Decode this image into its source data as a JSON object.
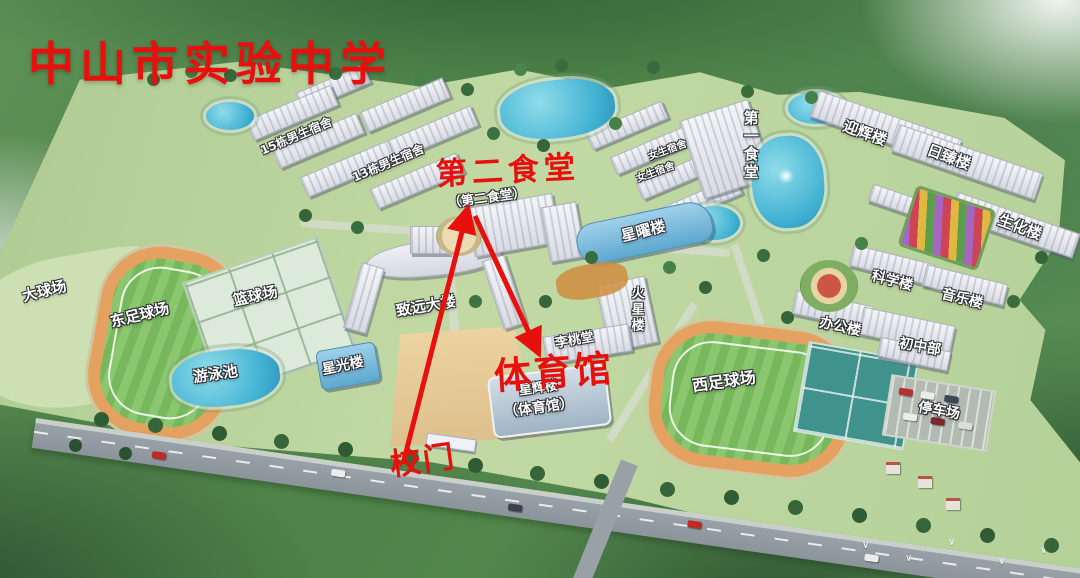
{
  "title": {
    "text": "中山市实验中学"
  },
  "colors": {
    "annotation": "#e8100c",
    "label": "#ffffff"
  },
  "annotations": [
    {
      "id": "second-canteen",
      "text": "第二食堂",
      "x": 436,
      "y": 156,
      "size": 31,
      "rot": -3,
      "ls": 5
    },
    {
      "id": "gymnasium",
      "text": "体育馆",
      "x": 494,
      "y": 354,
      "size": 37,
      "rot": -4,
      "ls": 3
    },
    {
      "id": "school-gate",
      "text": "校门",
      "x": 390,
      "y": 446,
      "size": 31,
      "rot": -8,
      "ls": 2
    }
  ],
  "arrows": [
    {
      "x1": 403,
      "y1": 464,
      "x2": 467,
      "y2": 212
    },
    {
      "x1": 475,
      "y1": 216,
      "x2": 537,
      "y2": 350
    }
  ],
  "map_labels": [
    {
      "text": "大球场",
      "x": 22,
      "y": 284,
      "rot": -14,
      "size": 15
    },
    {
      "text": "东足球场",
      "x": 110,
      "y": 308,
      "rot": -14,
      "size": 15
    },
    {
      "text": "篮球场",
      "x": 233,
      "y": 289,
      "rot": -12,
      "size": 15
    },
    {
      "text": "游泳池",
      "x": 193,
      "y": 367,
      "rot": -8,
      "size": 15
    },
    {
      "text": "星光楼",
      "x": 322,
      "y": 359,
      "rot": -12,
      "size": 14
    },
    {
      "text": "致远大楼",
      "x": 396,
      "y": 299,
      "rot": -10,
      "size": 15
    },
    {
      "text": "（第二食堂）",
      "x": 448,
      "y": 192,
      "rot": -8,
      "size": 13
    },
    {
      "text": "15栋男生宿舍",
      "x": 258,
      "y": 130,
      "rot": -23,
      "size": 12
    },
    {
      "text": "13栋男生宿舍",
      "x": 350,
      "y": 157,
      "rot": -23,
      "size": 12
    },
    {
      "text": "女生宿舍",
      "x": 648,
      "y": 146,
      "rot": -20,
      "size": 10
    },
    {
      "text": "女生宿舍",
      "x": 636,
      "y": 168,
      "rot": -20,
      "size": 10
    },
    {
      "text": "第一食堂",
      "x": 742,
      "y": 110,
      "rot": 0,
      "size": 15,
      "vertical": true
    },
    {
      "text": "迎辉楼",
      "x": 842,
      "y": 126,
      "rot": 20,
      "size": 15
    },
    {
      "text": "日臻楼",
      "x": 926,
      "y": 150,
      "rot": 20,
      "size": 15
    },
    {
      "text": "生化楼",
      "x": 997,
      "y": 220,
      "rot": 20,
      "size": 15
    },
    {
      "text": "星曜楼",
      "x": 621,
      "y": 224,
      "rot": -14,
      "size": 15
    },
    {
      "text": "火星楼",
      "x": 629,
      "y": 286,
      "rot": 0,
      "size": 13,
      "vertical": true
    },
    {
      "text": "李桃堂",
      "x": 555,
      "y": 334,
      "rot": -10,
      "size": 13
    },
    {
      "text": "星辉楼",
      "x": 519,
      "y": 382,
      "rot": -8,
      "size": 13
    },
    {
      "text": "（体育馆）",
      "x": 504,
      "y": 401,
      "rot": -8,
      "size": 14
    },
    {
      "text": "科学楼",
      "x": 871,
      "y": 274,
      "rot": 14,
      "size": 14
    },
    {
      "text": "音乐楼",
      "x": 941,
      "y": 292,
      "rot": 14,
      "size": 14
    },
    {
      "text": "办公楼",
      "x": 819,
      "y": 320,
      "rot": 12,
      "size": 14
    },
    {
      "text": "初中部",
      "x": 899,
      "y": 340,
      "rot": 10,
      "size": 14
    },
    {
      "text": "停车场",
      "x": 918,
      "y": 404,
      "rot": 10,
      "size": 14
    },
    {
      "text": "西足球场",
      "x": 692,
      "y": 374,
      "rot": -8,
      "size": 16
    }
  ]
}
